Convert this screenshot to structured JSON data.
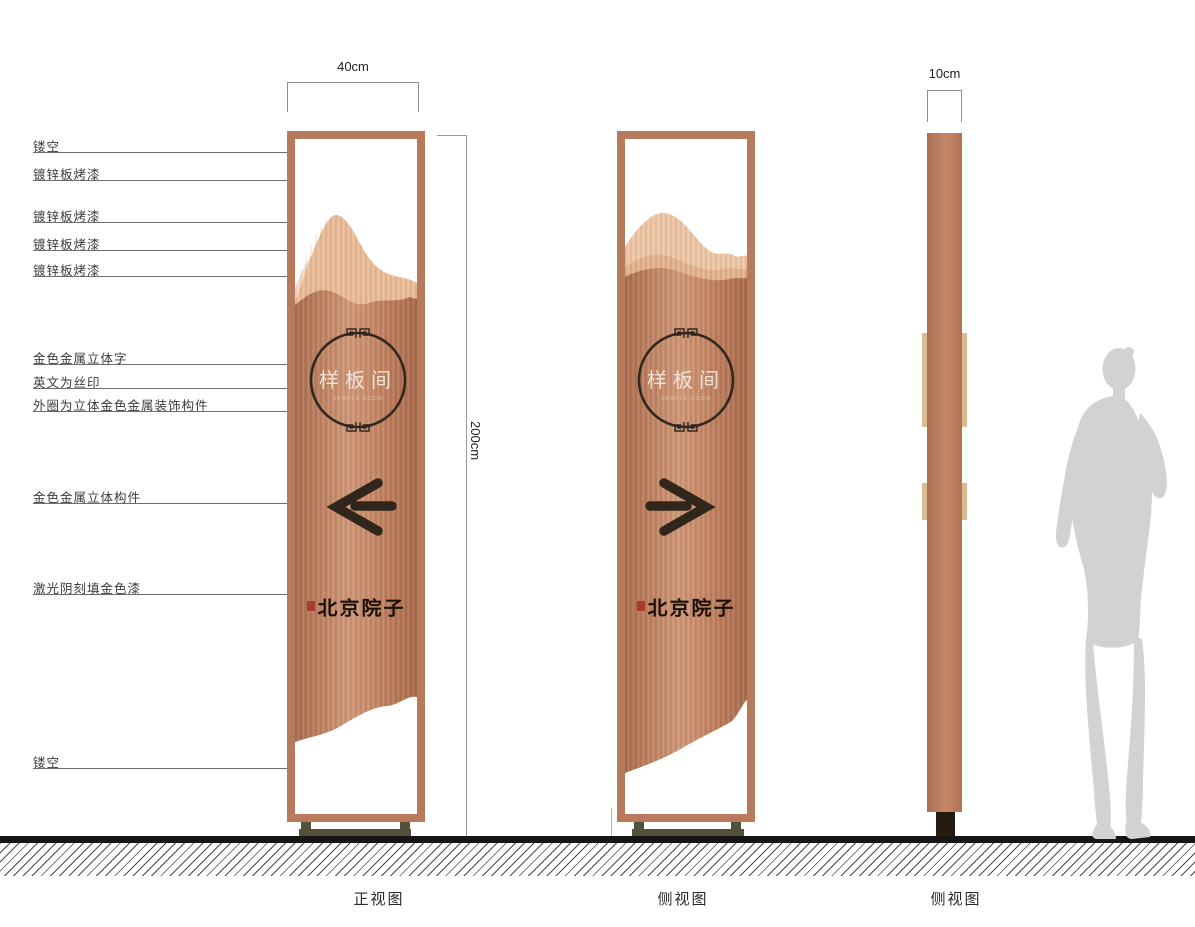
{
  "drawing": {
    "dim_width": "40cm",
    "dim_height": "200cm",
    "dim_depth": "10cm"
  },
  "callouts": [
    "镂空",
    "镀锌板烤漆",
    "镀锌板烤漆",
    "镀锌板烤漆",
    "镀锌板烤漆",
    "金色金属立体字",
    "英文为丝印",
    "外圈为立体金色金属装饰构件",
    "金色金属立体构件",
    "激光阴刻填金色漆",
    "镂空"
  ],
  "sign": {
    "room_name": "样板间",
    "room_name_en": "SAMPLE ROOM",
    "brand": "北京院子",
    "arrow_front": "left",
    "arrow_side": "right"
  },
  "views": [
    "正视图",
    "侧视图",
    "侧视图"
  ],
  "colors": {
    "copper_frame": "#b77a5d",
    "copper_body": "#c98f6e",
    "mountain_light": "#f4dcc6",
    "accent_ink": "#31261c",
    "trim_tan": "#d7bc93",
    "seal_red": "#a93b2d",
    "ground_ink": "#161616",
    "figure_gray": "#d2d2d2"
  }
}
